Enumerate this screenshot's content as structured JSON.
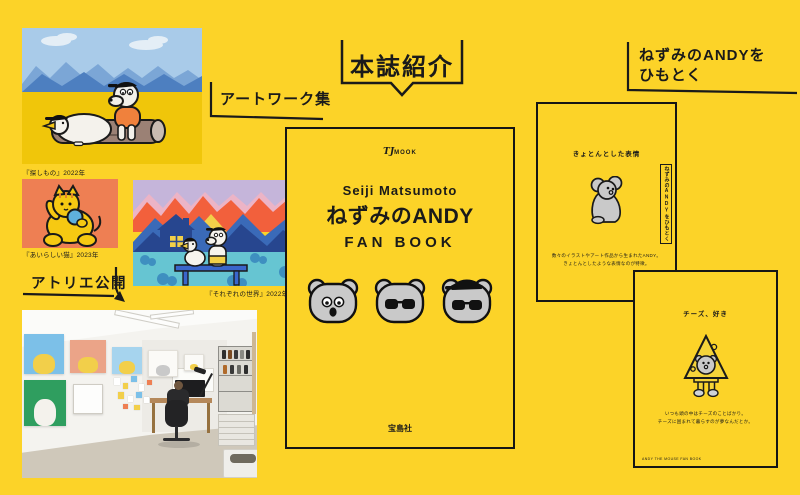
{
  "theme": {
    "bg_yellow": "#fcd328",
    "ink": "#1a1a1a",
    "cover_gray": "#c9c9c9"
  },
  "labels": {
    "artwork_collection": "アートワーク集",
    "book_intro": "本誌紹介",
    "himotoku_line1": "ねずみのANDYを",
    "himotoku_line2": "ひもとく",
    "atelier_open": "アトリエ公開"
  },
  "artworks": [
    {
      "name": "dog-and-goose-on-log",
      "caption": "『探しもの』2022年"
    },
    {
      "name": "yellow-cat",
      "caption": "『あいらしい猫』2023年"
    },
    {
      "name": "mountains-and-house",
      "caption": "『それぞれの世界』2022年"
    }
  ],
  "cover": {
    "imprint_tj": "TJ",
    "imprint_mook": "MOOK",
    "author": "Seiji Matsumoto",
    "title": "ねずみのANDY",
    "subtitle": "FAN BOOK",
    "publisher": "宝島社"
  },
  "pages": [
    {
      "title": "きょとんとした表情",
      "caption_line1": "数々のイラストやアート作品から生まれたANDY。",
      "caption_line2": "きょとんとしたような表情なのが特徴。",
      "side_tab": "ねずみのANDYをひもとく"
    },
    {
      "title": "チーズ、好き",
      "caption_line1": "いつも頭の中はチーズのことばかり。",
      "caption_line2": "チーズに囲まれて暮らすのが夢なんだとか。",
      "footer": "ANDY THE MOUSE FAN BOOK"
    }
  ]
}
